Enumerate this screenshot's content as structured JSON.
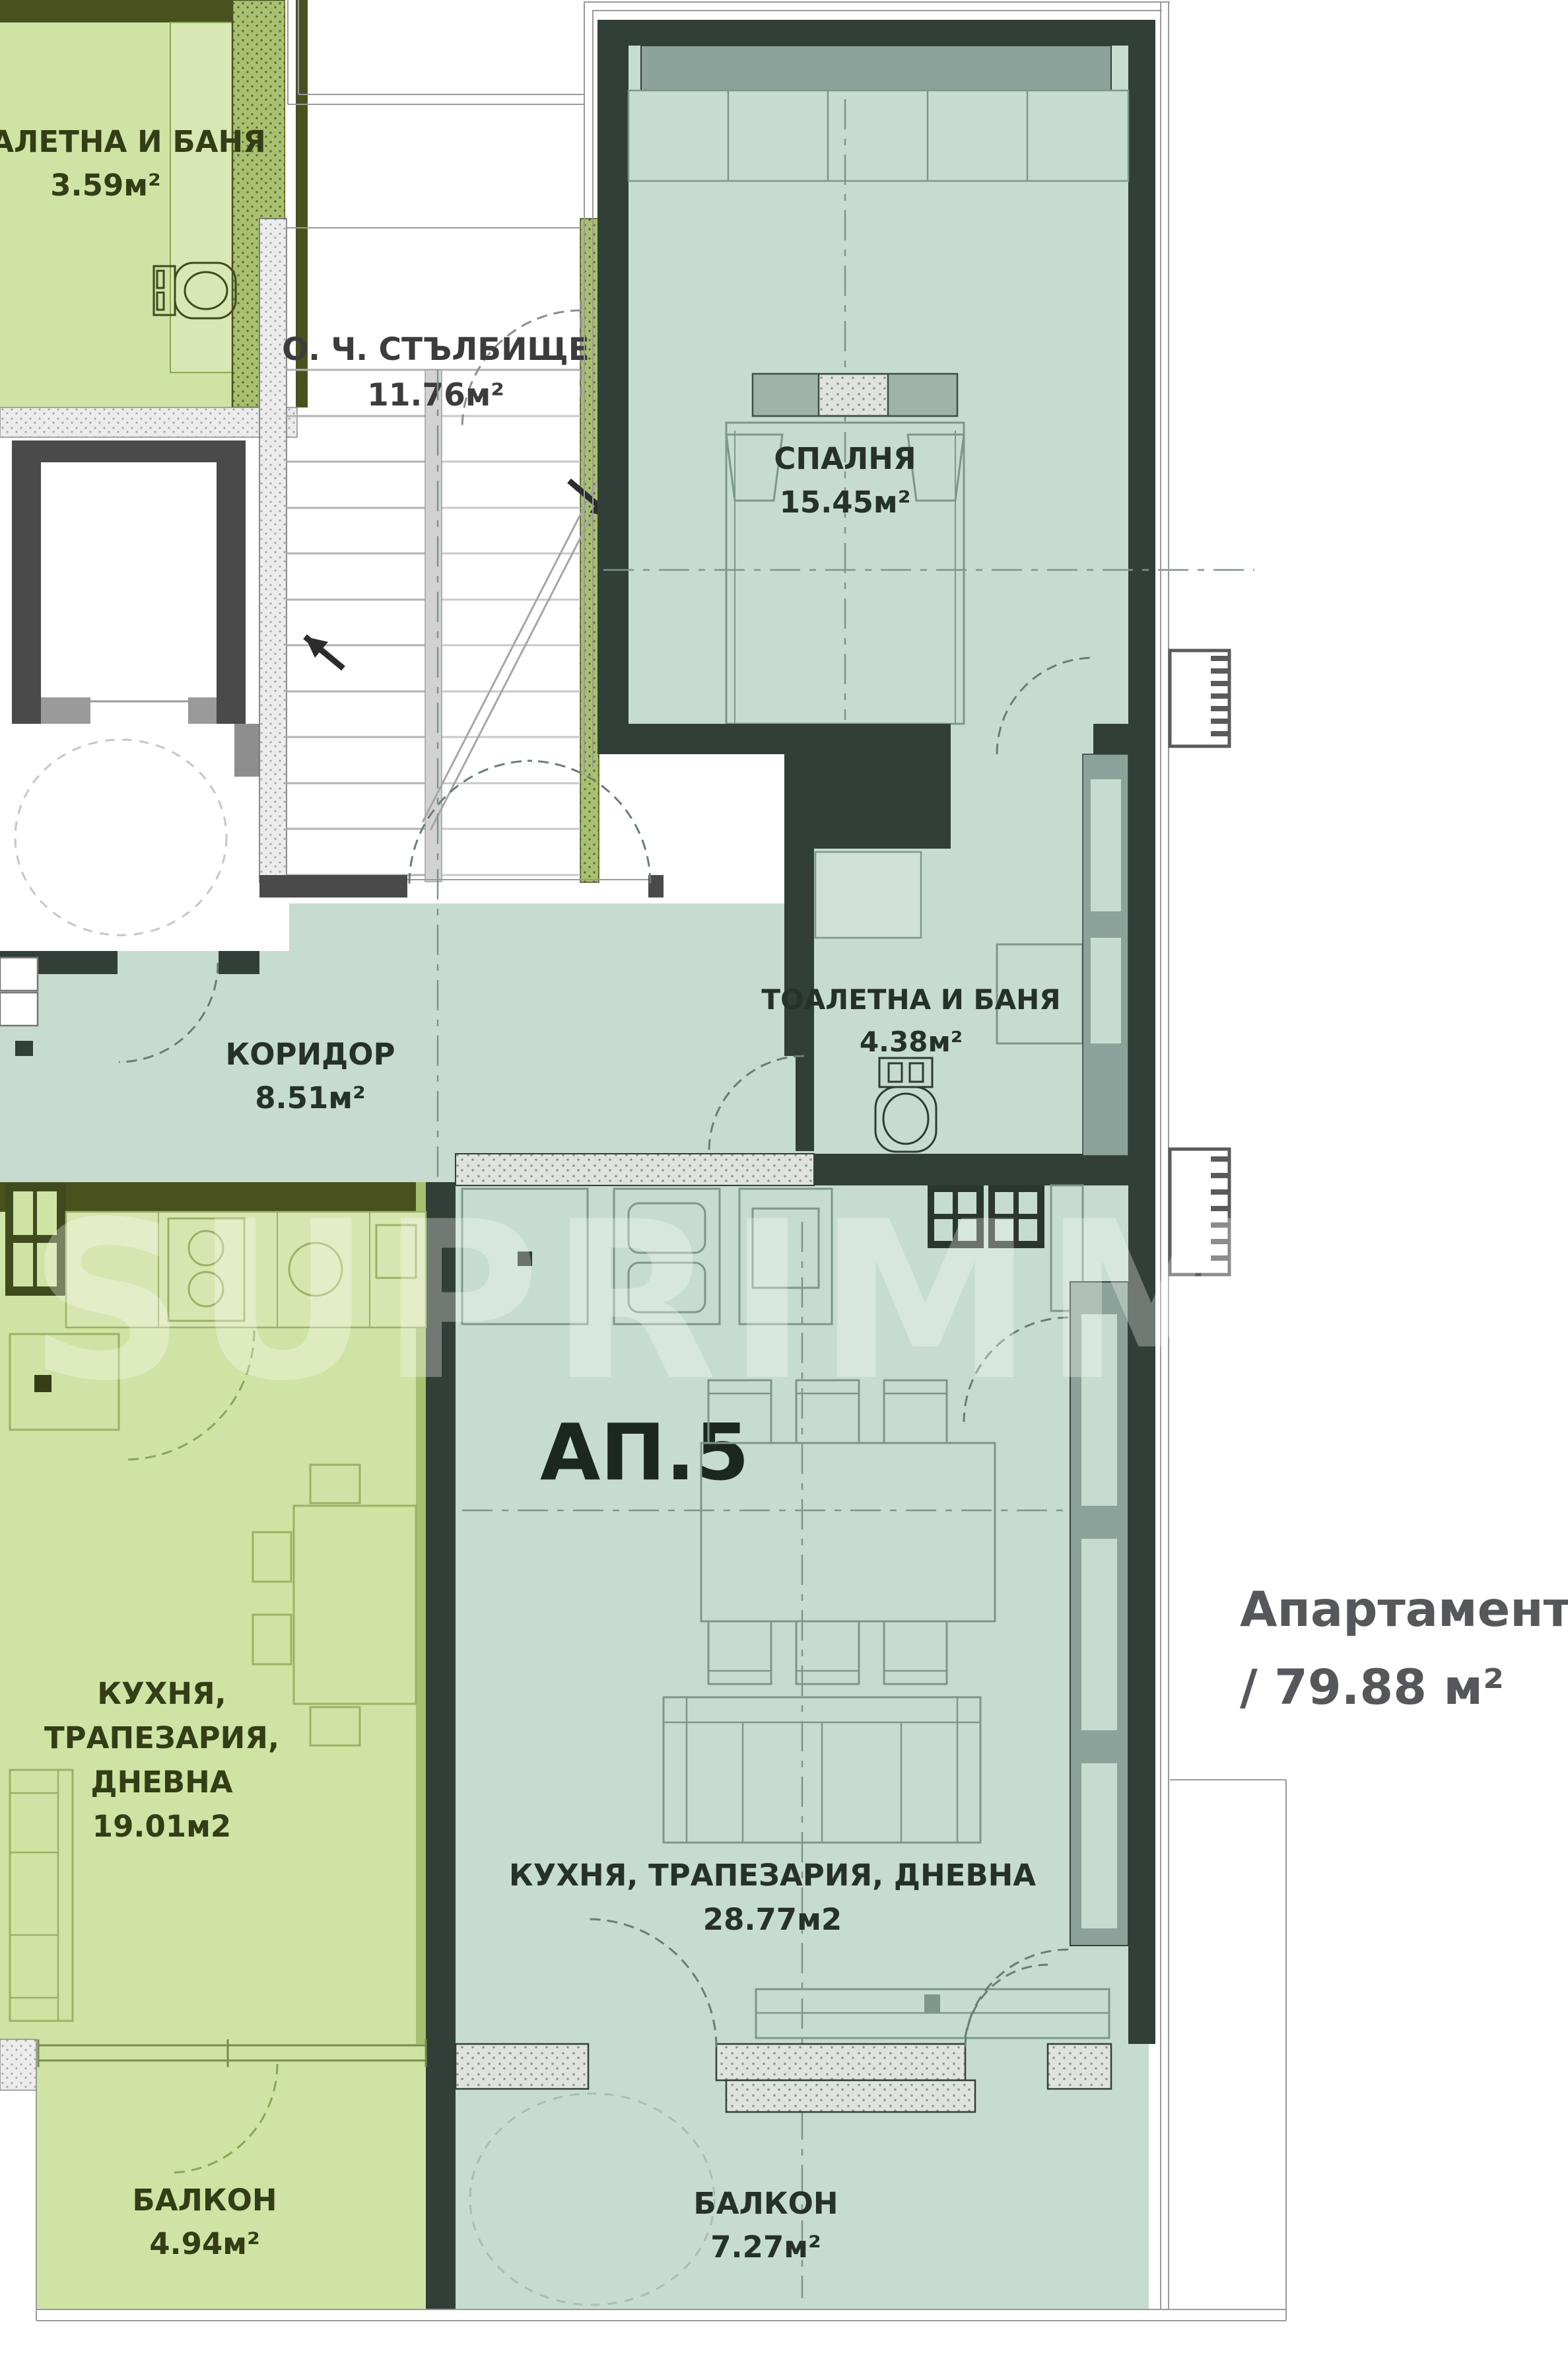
{
  "plan": {
    "apartment_label": "АП.5",
    "title_line1": "Апартамент 5",
    "title_line2": "/ 79.88 м²",
    "watermark": "SUPRIMMO"
  },
  "rooms": {
    "toilet_top": {
      "name": "ТОАЛЕТНА И БАНЯ",
      "area": "3.59м²"
    },
    "stairwell": {
      "name": "О. Ч. СТЪЛБИЩЕ",
      "area": "11.76м²"
    },
    "bedroom": {
      "name": "СПАЛНЯ",
      "area": "15.45м²"
    },
    "bathroom": {
      "name": "ТОАЛЕТНА И БАНЯ",
      "area": "4.38м²"
    },
    "corridor": {
      "name": "КОРИДОР",
      "area": "8.51м²"
    },
    "kitchen_left": {
      "line1": "КУХНЯ,",
      "line2": "ТРАПЕЗАРИЯ,",
      "line3": "ДНЕВНА",
      "area": "19.01м2"
    },
    "kitchen_main": {
      "name": "КУХНЯ, ТРАПЕЗАРИЯ, ДНЕВНА",
      "area": "28.77м2"
    },
    "balcony_left": {
      "name": "БАЛКОН",
      "area": "4.94м²"
    },
    "balcony_main": {
      "name": "БАЛКОН",
      "area": "7.27м²"
    }
  },
  "colors": {
    "green_fill": "#cfe3a4",
    "teal_fill": "#c6dcd0",
    "wall_dark": "#323f38",
    "wall_olive": "#49521f",
    "wall_gray": "#4a4a4a",
    "band_gray_teal": "#8ba39a",
    "title_gray": "#56575b"
  }
}
